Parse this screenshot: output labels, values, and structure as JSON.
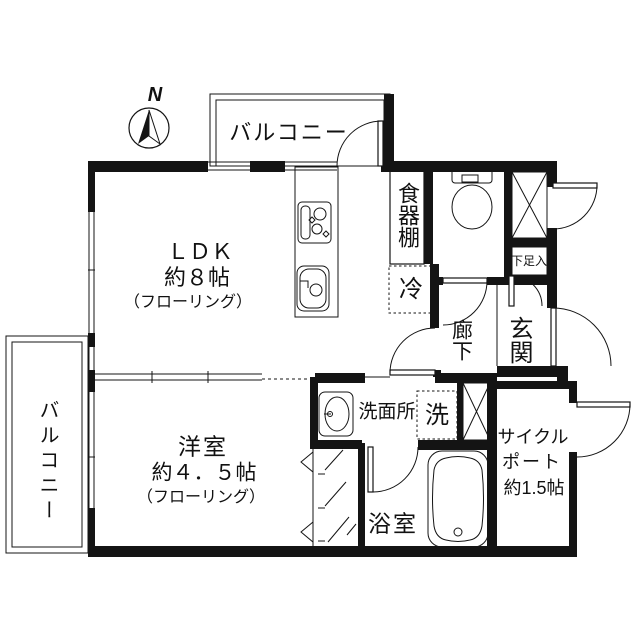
{
  "compass": {
    "north": "N"
  },
  "labels": {
    "balcony_top": "バルコニー",
    "balcony_left": "バルコニー",
    "ldk_name": "ＬＤＫ",
    "ldk_size": "約８帖",
    "ldk_finish": "（フローリング）",
    "dish_shelf": "食器棚",
    "fridge": "冷",
    "shoe_box": "下足入",
    "hallway": "廊下",
    "entrance": "玄関",
    "washroom": "洗面所",
    "washer": "洗",
    "bathroom": "浴室",
    "cycle_port_line1": "サイクル",
    "cycle_port_line2": "ポート",
    "cycle_port_size": "約1.5帖",
    "western_room_name": "洋室",
    "western_room_size": "約４．５帖",
    "western_room_finish": "（フローリング）"
  },
  "colors": {
    "line": "#141414",
    "background": "#ffffff"
  }
}
